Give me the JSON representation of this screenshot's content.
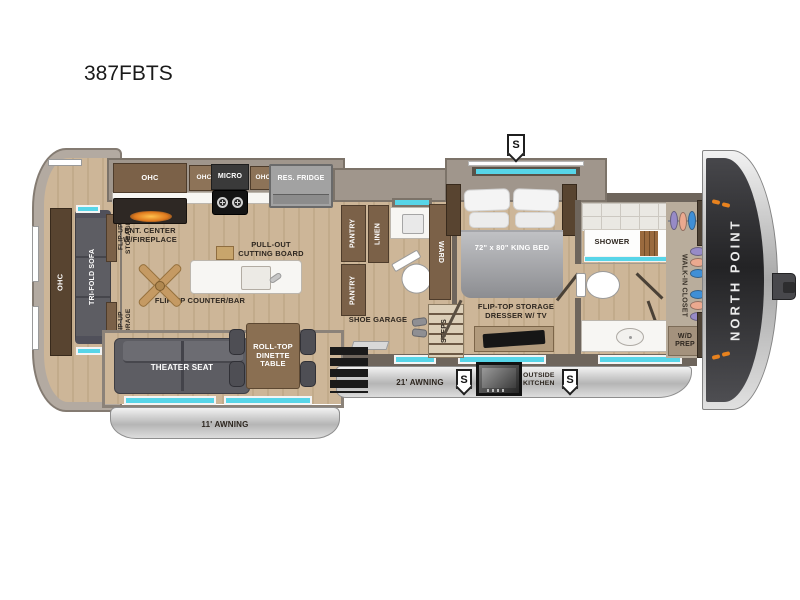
{
  "title": "387FBTS",
  "living": {
    "ohc_rear": "OHC",
    "sofa": "TRI-FOLD SOFA",
    "flip_up_a": "FLIP-UP STORAGE",
    "flip_up_b": "FLIP-UP STORAGE",
    "ent_center": "ENT. CENTER W/FIREPLACE",
    "theater": "THEATER SEAT",
    "dinette": "ROLL-TOP DINETTE TABLE"
  },
  "kitchen": {
    "ohc1": "OHC",
    "ohc2": "OHC",
    "micro": "MICRO",
    "ohc3": "OHC",
    "fridge": "RES. FRIDGE",
    "cutting_board": "PULL-OUT CUTTING BOARD",
    "counter_bar": "FLIP-UP COUNTER/BAR"
  },
  "hall": {
    "pantry_a": "PANTRY",
    "pantry_b": "PANTRY",
    "linen": "LINEN",
    "ward": "WARD",
    "shoe_garage": "SHOE GARAGE",
    "steps": "STEPS"
  },
  "bedroom": {
    "bed": "72\" x 80\" KING BED",
    "dresser": "FLIP-TOP STORAGE DRESSER W/ TV"
  },
  "bath": {
    "shower": "SHOWER"
  },
  "closet": {
    "walk_in": "WALK-IN CLOSET",
    "shelves_top": "SHELVES",
    "shelves_bottom": "SHELVES",
    "wd_prep": "W/D PREP"
  },
  "exterior": {
    "awning_left": "11' AWNING",
    "awning_main": "21' AWNING",
    "outside_kitchen": "OUTSIDE KITCHEN",
    "brand": "NORTH POINT",
    "badge_s": "S"
  },
  "colors": {
    "floor_wood": "#cdb698",
    "wall": "#6e655c",
    "slide_shell": "#a0968c",
    "cabinet": "#7b6148",
    "upholstery": "#5d5d63",
    "window_glass": "#57d5e8",
    "awning_silver": "#c9c9c9",
    "front_cap": "#3a3a3e",
    "fireplace_accent": "#e07a1e",
    "clothes_purple": "#978bc7",
    "clothes_salmon": "#eba98f",
    "clothes_blue": "#3f8fd6"
  }
}
